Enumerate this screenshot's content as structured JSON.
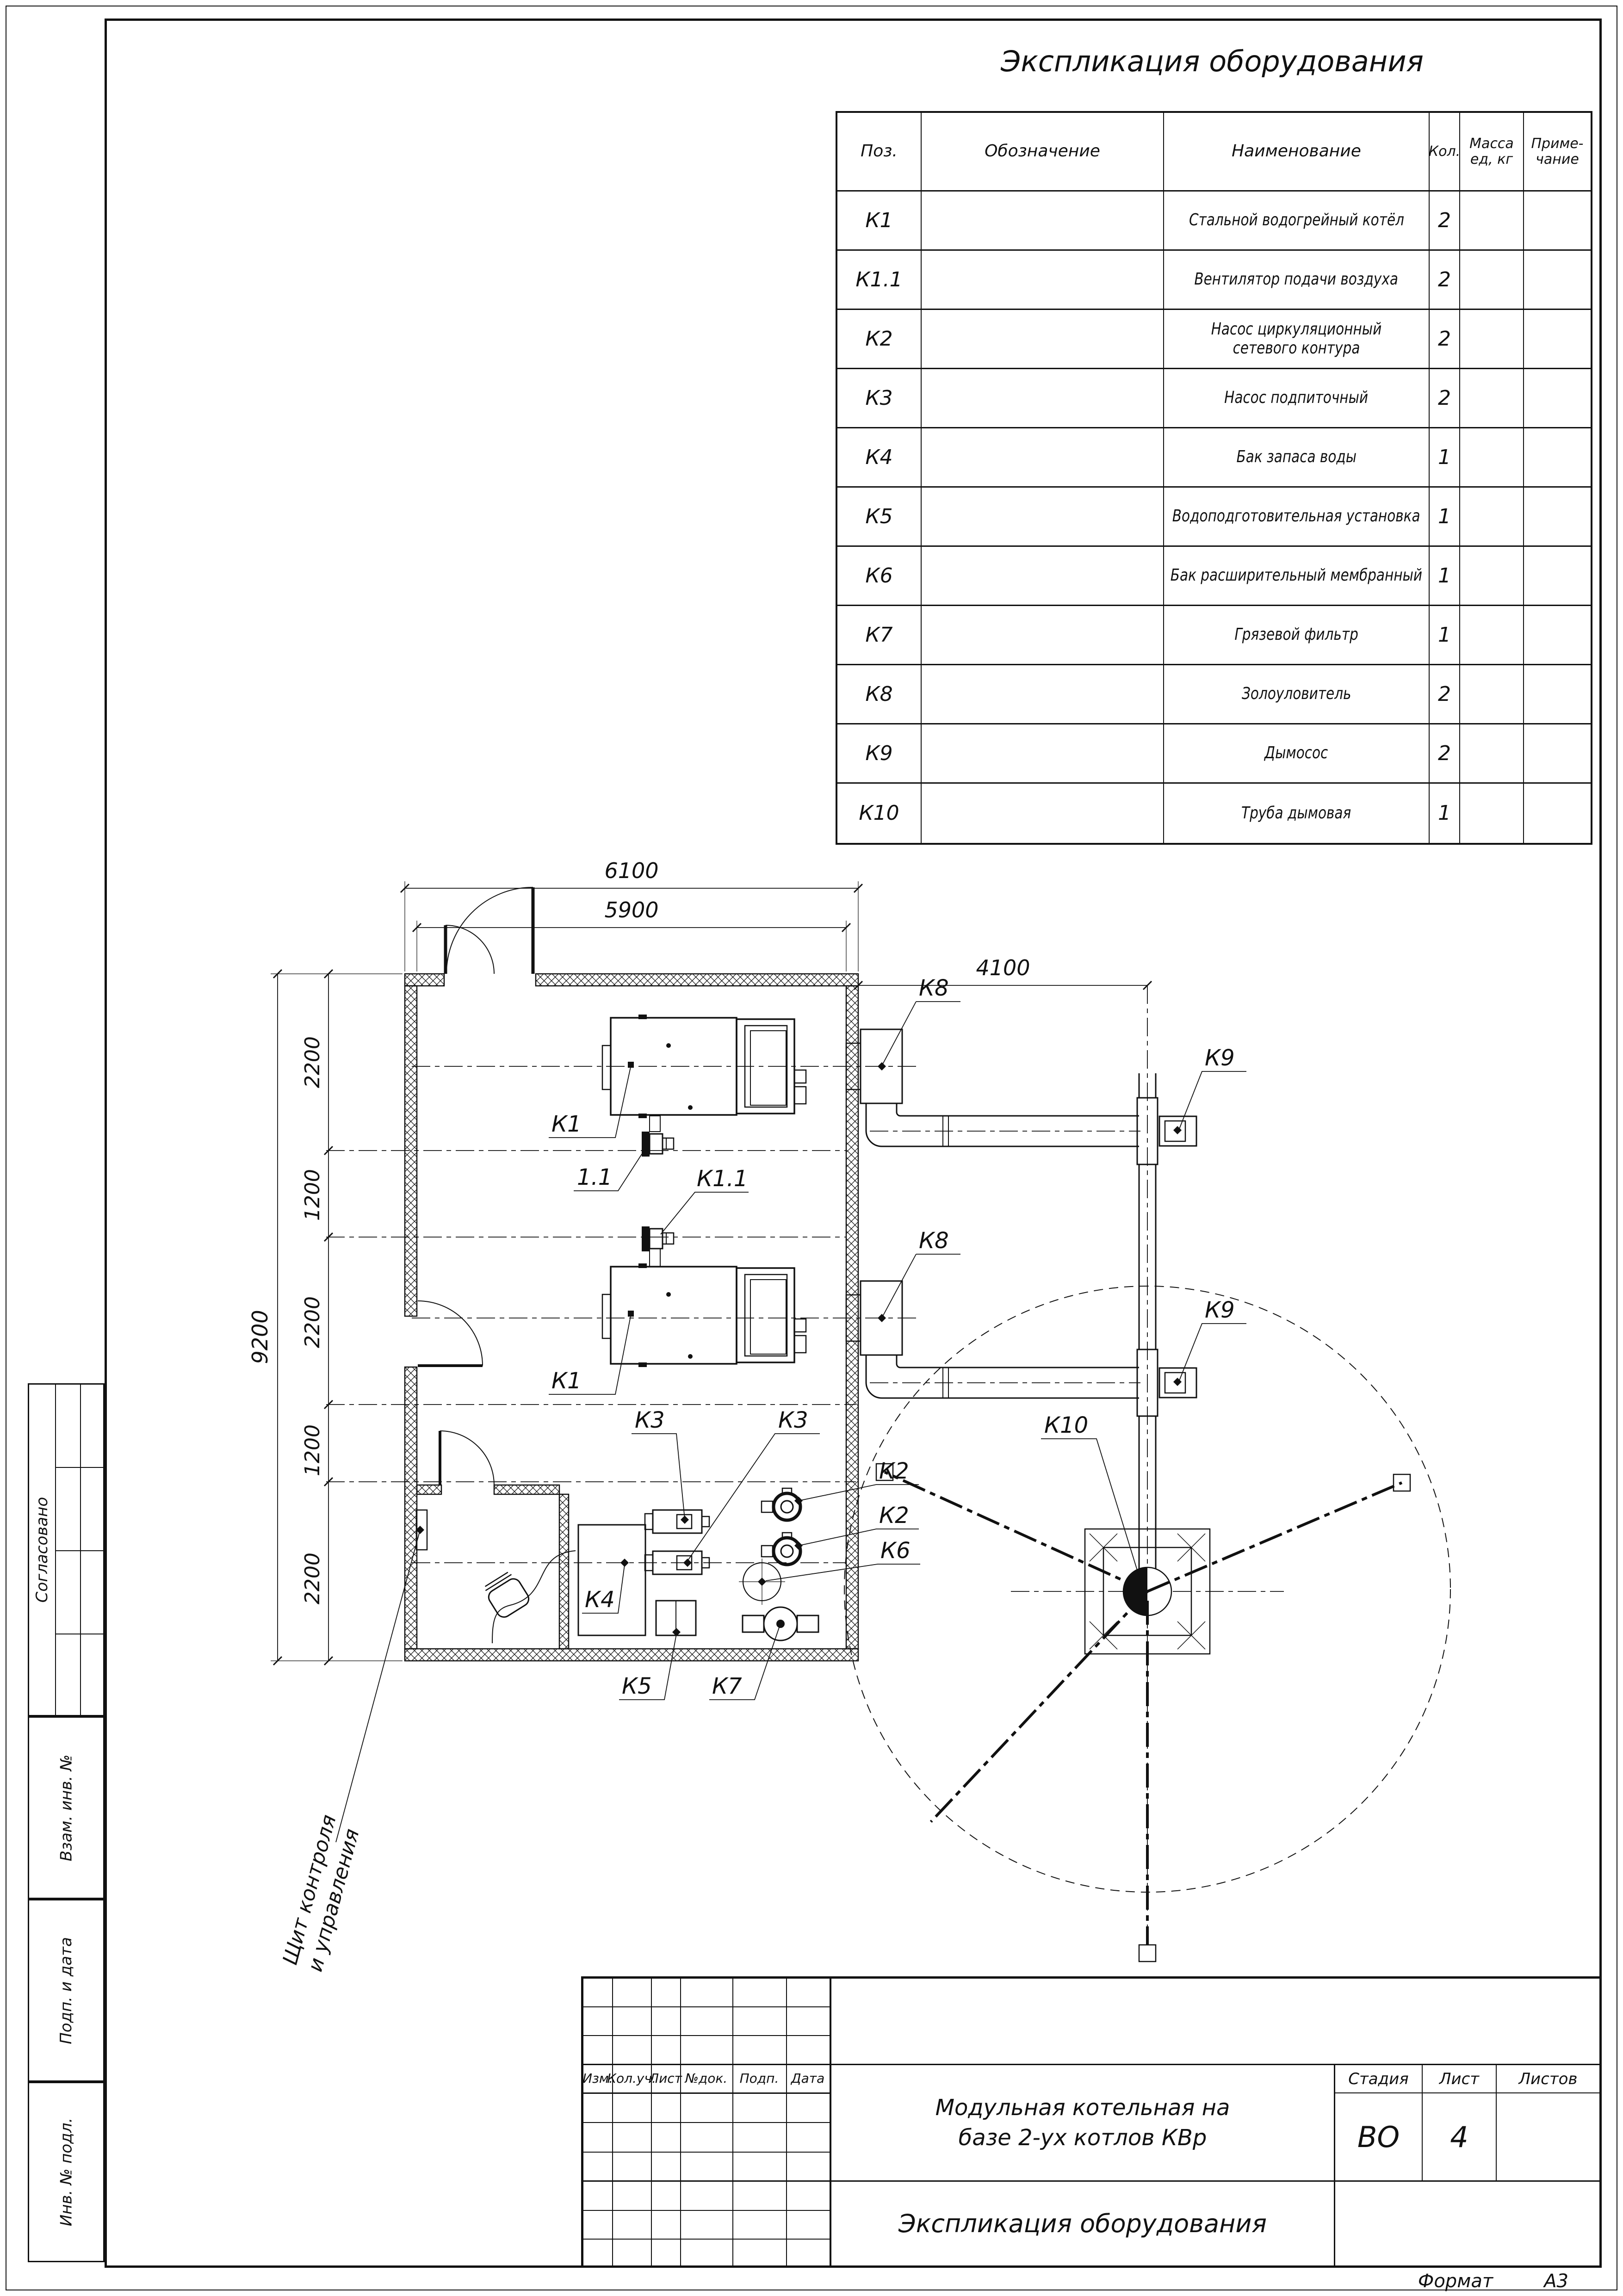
{
  "table": {
    "title": "Экспликация оборудования",
    "col_pos": "Поз.",
    "col_desig": "Обозначение",
    "col_name": "Наименование",
    "col_qty": "Кол.",
    "col_mass1": "Масса",
    "col_mass2": "ед, кг",
    "col_note1": "Приме-",
    "col_note2": "чание",
    "rows": [
      {
        "pos": "К1",
        "desig": "",
        "name": "Стальной водогрейный котёл",
        "qty": "2",
        "mass": "",
        "note": ""
      },
      {
        "pos": "К1.1",
        "desig": "",
        "name": "Вентилятор подачи воздуха",
        "qty": "2",
        "mass": "",
        "note": ""
      },
      {
        "pos": "К2",
        "desig": "",
        "name": "Насос циркуляционный сетевого контура",
        "qty": "2",
        "mass": "",
        "note": ""
      },
      {
        "pos": "К3",
        "desig": "",
        "name": "Насос подпиточный",
        "qty": "2",
        "mass": "",
        "note": ""
      },
      {
        "pos": "К4",
        "desig": "",
        "name": "Бак запаса воды",
        "qty": "1",
        "mass": "",
        "note": ""
      },
      {
        "pos": "К5",
        "desig": "",
        "name": "Водоподготовительная установка",
        "qty": "1",
        "mass": "",
        "note": ""
      },
      {
        "pos": "К6",
        "desig": "",
        "name": "Бак расширительный мембранный",
        "qty": "1",
        "mass": "",
        "note": ""
      },
      {
        "pos": "К7",
        "desig": "",
        "name": "Грязевой фильтр",
        "qty": "1",
        "mass": "",
        "note": ""
      },
      {
        "pos": "К8",
        "desig": "",
        "name": "Золоуловитель",
        "qty": "2",
        "mass": "",
        "note": ""
      },
      {
        "pos": "К9",
        "desig": "",
        "name": "Дымосос",
        "qty": "2",
        "mass": "",
        "note": ""
      },
      {
        "pos": "К10",
        "desig": "",
        "name": "Труба дымовая",
        "qty": "1",
        "mass": "",
        "note": ""
      }
    ]
  },
  "plan": {
    "dim_6100": "6100",
    "dim_5900": "5900",
    "dim_9200": "9200",
    "dim_4100": "4100",
    "seg1": "2200",
    "seg2": "1200",
    "seg3": "2200",
    "seg4": "1200",
    "seg5": "2200",
    "k1a": "К1",
    "k1b": "К1",
    "fan_a": "1.1",
    "fan_b": "К1.1",
    "k2a": "К2",
    "k2b": "К2",
    "k3a": "К3",
    "k3b": "К3",
    "k4": "К4",
    "k5": "К5",
    "k6": "К6",
    "k7": "К7",
    "k8a": "К8",
    "k8b": "К8",
    "k9a": "К9",
    "k9b": "К9",
    "k10": "К10",
    "panel_line1": "Щит контроля",
    "panel_line2": "и управления"
  },
  "stamp": {
    "agreed": "Согласовано",
    "subst": "Взам. инв. №",
    "sign": "Подп. и дата",
    "inv": "Инв. № подл."
  },
  "tb": {
    "c1": "Изм.",
    "c2": "Кол.уч.",
    "c3": "Лист",
    "c4": "№док.",
    "c5": "Подп.",
    "c6": "Дата",
    "project1": "Модульная котельная на",
    "project2": "базе 2-ух котлов КВр",
    "stage_l": "Стадия",
    "sheet_l": "Лист",
    "sheets_l": "Листов",
    "stage": "ВО",
    "sheet": "4",
    "sheets": "",
    "doc": "Экспликация оборудования",
    "format_l": "Формат",
    "format_v": "А3"
  }
}
